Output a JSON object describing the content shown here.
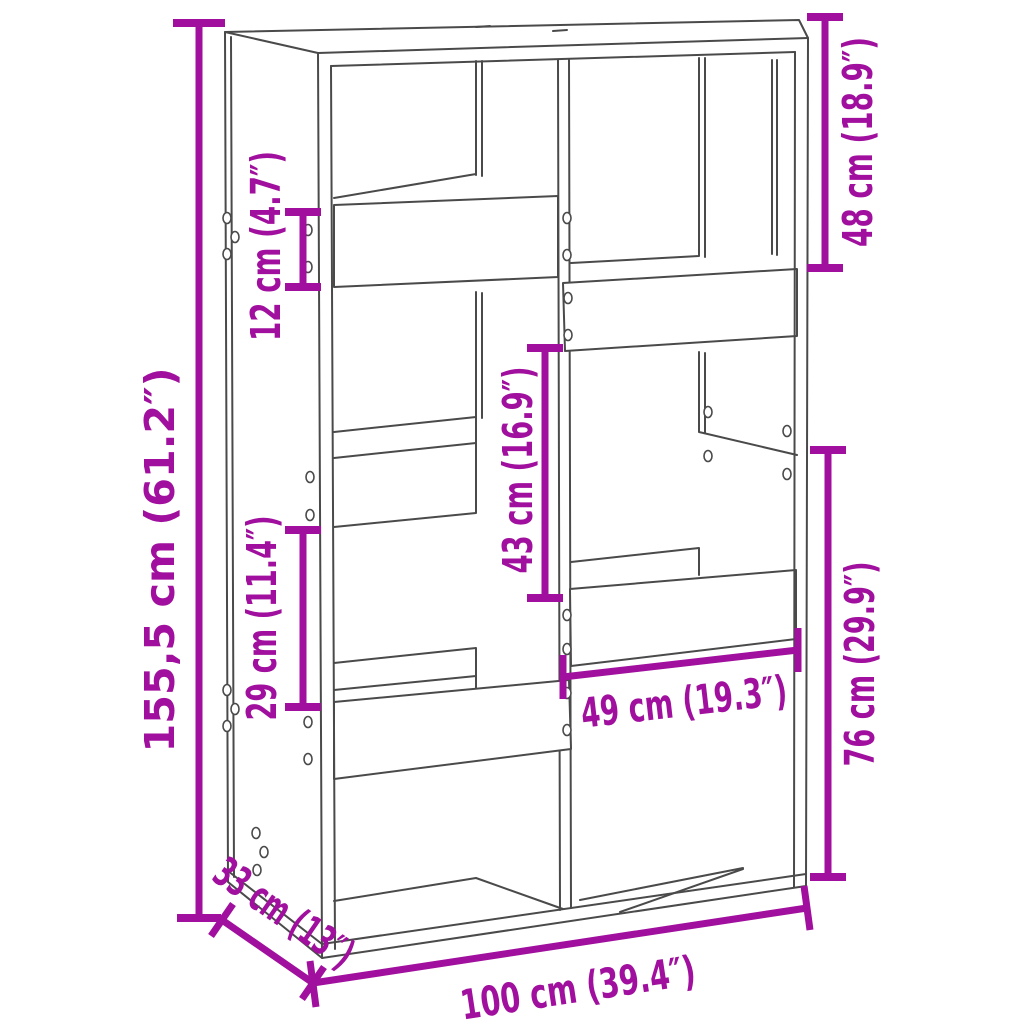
{
  "diagram": {
    "subject": "bookcase-room-divider",
    "colors": {
      "accent": "#a00f9d",
      "outline": "#4a4a4a",
      "background": "#ffffff"
    },
    "dimensions": {
      "total_height": "155,5 cm (61.2″)",
      "shelf_board_height": "12 cm (4.7″)",
      "lower_left_compartment_height": "29 cm (11.4″)",
      "middle_compartment_height": "43 cm (16.9″)",
      "top_right_compartment_height": "48 cm (18.9″)",
      "bottom_right_section_height": "76 cm (29.9″)",
      "compartment_width": "49 cm (19.3″)",
      "depth": "33 cm (13″)",
      "total_width": "100 cm (39.4″)"
    }
  }
}
